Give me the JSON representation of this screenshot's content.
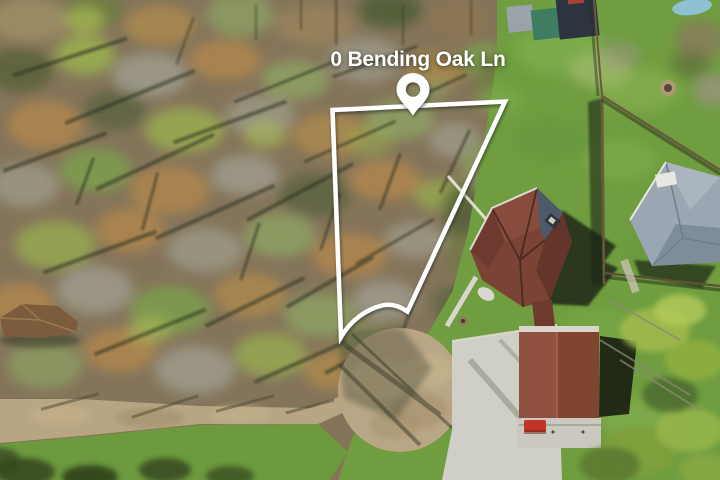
{
  "listing_photo": {
    "address_label": "0 Bending Oak Ln",
    "annotation": {
      "marker": "location-pin",
      "boundary": "property-lot-outline",
      "color": "#ffffff"
    },
    "palette": {
      "woods": "#84745a",
      "lawn": "#6f9d3f",
      "dirt_road": "#b7a584",
      "cul_de_sac": "#b9a686",
      "concrete": "#cfcec7",
      "main_roof": "#7b4336",
      "garage_roof": "#80442f",
      "gray_roof": "#9aa7b2",
      "barn_roof": "#2c3440",
      "tarp": "#3f7d63",
      "gazebo_roof": "#7c5c3c",
      "shadow": "#1d2418",
      "text": "#ffffff"
    }
  }
}
